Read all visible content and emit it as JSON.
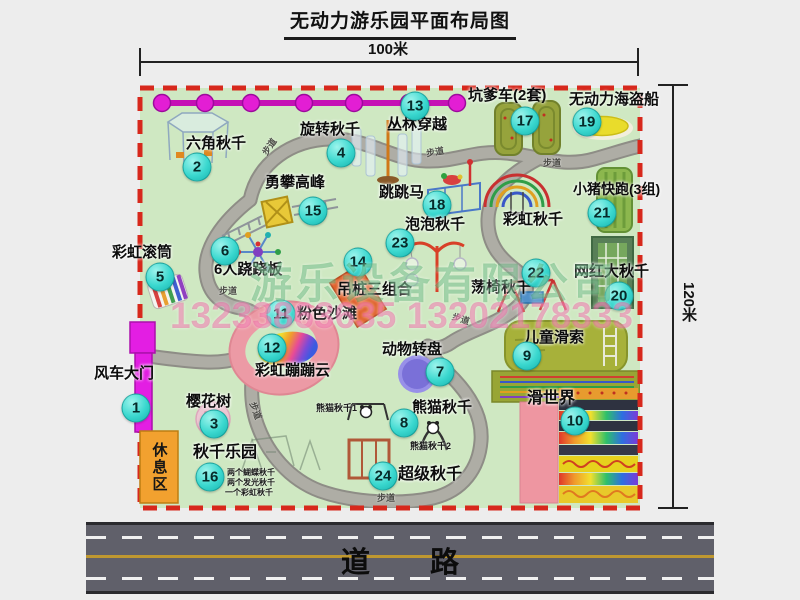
{
  "title": "无动力游乐园平面布局图",
  "dimensions": {
    "width": "100米",
    "height": "120米"
  },
  "road": {
    "label": "道 路"
  },
  "watermark": {
    "company": "游乐设备有限公司",
    "phone": "13233863635 13202178333"
  },
  "rest_area": {
    "label": "休息区"
  },
  "trail_label_text": "步道",
  "colors": {
    "park_green": "#cfe8c2",
    "border_red": "#d7281c",
    "bubble_teal": "#3bd8cf",
    "gate_magenta": "#e31ee3",
    "jungle_line_magenta": "#d414c4",
    "road_gray": "#60606a",
    "rest_area_orange": "#f2a12f",
    "watermark_green": "rgba(25,145,65,0.33)",
    "watermark_pink": "rgba(233,72,145,0.42)"
  },
  "map": {
    "attractions": [
      {
        "num": "1",
        "label": "风车大门",
        "lx": 94,
        "ly": 366,
        "bx": 136,
        "by": 408
      },
      {
        "num": "2",
        "label": "六角秋千",
        "lx": 186,
        "ly": 136,
        "bx": 197,
        "by": 167
      },
      {
        "num": "3",
        "label": "樱花树",
        "lx": 186,
        "ly": 394,
        "bx": 214,
        "by": 424
      },
      {
        "num": "4",
        "label": "旋转秋千",
        "lx": 300,
        "ly": 122,
        "bx": 341,
        "by": 153
      },
      {
        "num": "5",
        "label": "彩虹滚筒",
        "lx": 112,
        "ly": 245,
        "bx": 160,
        "by": 277
      },
      {
        "num": "6",
        "label": "6人跷跷板",
        "lx": 214,
        "ly": 262,
        "bx": 225,
        "by": 251
      },
      {
        "num": "7",
        "label": "动物转盘",
        "lx": 382,
        "ly": 342,
        "bx": 440,
        "by": 372
      },
      {
        "num": "8",
        "label": "熊猫秋千",
        "lx": 412,
        "ly": 400,
        "bx": 404,
        "by": 423
      },
      {
        "num": "9",
        "label": "儿童滑索",
        "lx": 524,
        "ly": 330,
        "bx": 527,
        "by": 356
      },
      {
        "num": "10",
        "label": "滑世界",
        "lx": 527,
        "ly": 391,
        "bx": 575,
        "by": 421,
        "fs": 16
      },
      {
        "num": "11",
        "label": "粉色沙滩",
        "lx": 297,
        "ly": 306,
        "bx": 281,
        "by": 314
      },
      {
        "num": "12",
        "label": "彩虹蹦蹦云",
        "lx": 255,
        "ly": 363,
        "bx": 272,
        "by": 348
      },
      {
        "num": "13",
        "label": "丛林穿越",
        "lx": 387,
        "ly": 117,
        "bx": 415,
        "by": 106
      },
      {
        "num": "14",
        "label": "吊桩三组合",
        "lx": 337,
        "ly": 282,
        "bx": 358,
        "by": 262
      },
      {
        "num": "15",
        "label": "勇攀高峰",
        "lx": 265,
        "ly": 175,
        "bx": 313,
        "by": 211
      },
      {
        "num": "16",
        "label": "秋千乐园",
        "lx": 193,
        "ly": 445,
        "bx": 210,
        "by": 477,
        "fs": 16
      },
      {
        "num": "17",
        "label": "坑爹车(2套)",
        "lx": 468,
        "ly": 88,
        "bx": 525,
        "by": 121
      },
      {
        "num": "18",
        "label": "跳跳马",
        "lx": 379,
        "ly": 185,
        "bx": 437,
        "by": 205
      },
      {
        "num": "19",
        "label": "无动力海盗船",
        "lx": 569,
        "ly": 92,
        "bx": 587,
        "by": 122
      },
      {
        "num": "20",
        "label": "网红大秋千",
        "lx": 574,
        "ly": 264,
        "bx": 619,
        "by": 296
      },
      {
        "num": "21",
        "label": "小猪快跑(3组)",
        "lx": 573,
        "ly": 182,
        "bx": 602,
        "by": 213,
        "fs": 14
      },
      {
        "num": "22",
        "label": "荡椅秋千",
        "lx": 471,
        "ly": 280,
        "bx": 536,
        "by": 273
      },
      {
        "num": "23",
        "label": "泡泡秋千",
        "lx": 405,
        "ly": 217,
        "bx": 400,
        "by": 243
      },
      {
        "num": "24",
        "label": "超级秋千",
        "lx": 398,
        "ly": 467,
        "bx": 383,
        "by": 476,
        "fs": 16
      },
      {
        "num": null,
        "label": "彩虹秋千",
        "lx": 503,
        "ly": 212
      }
    ],
    "sub_labels": [
      {
        "text": "熊猫秋千1",
        "x": 316,
        "y": 401,
        "fs": 9
      },
      {
        "text": "熊猫秋千2",
        "x": 410,
        "y": 439,
        "fs": 9
      },
      {
        "text": "两个蝴蝶秋千",
        "x": 227,
        "y": 467,
        "fs": 8
      },
      {
        "text": "两个发光秋千",
        "x": 227,
        "y": 477,
        "fs": 8
      },
      {
        "text": "一个彩虹秋千",
        "x": 225,
        "y": 487,
        "fs": 8
      }
    ],
    "trail_labels": [
      {
        "x": 260,
        "y": 140,
        "r": -55
      },
      {
        "x": 426,
        "y": 145,
        "r": -10
      },
      {
        "x": 543,
        "y": 156,
        "r": 0
      },
      {
        "x": 219,
        "y": 284,
        "r": 0
      },
      {
        "x": 247,
        "y": 404,
        "r": 70
      },
      {
        "x": 377,
        "y": 491,
        "r": 0
      },
      {
        "x": 452,
        "y": 312,
        "r": 18
      }
    ]
  }
}
